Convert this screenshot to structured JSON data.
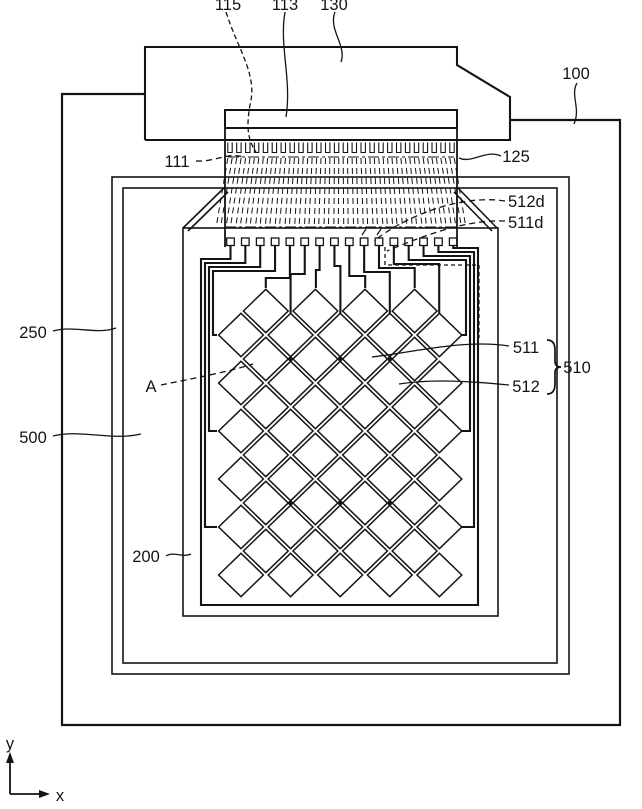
{
  "figure": {
    "kind": "patent-line-drawing",
    "colors": {
      "line": "#141414",
      "background": "#ffffff"
    },
    "labels": {
      "l115": "115",
      "l113": "113",
      "l130": "130",
      "l100": "100",
      "l111": "111",
      "l125": "125",
      "l512d": "512d",
      "l511d": "511d",
      "l250": "250",
      "lA": "A",
      "l500": "500",
      "l200": "200",
      "l511": "511",
      "l512": "512",
      "l510": "510",
      "axis_x": "x",
      "axis_y": "y"
    }
  }
}
